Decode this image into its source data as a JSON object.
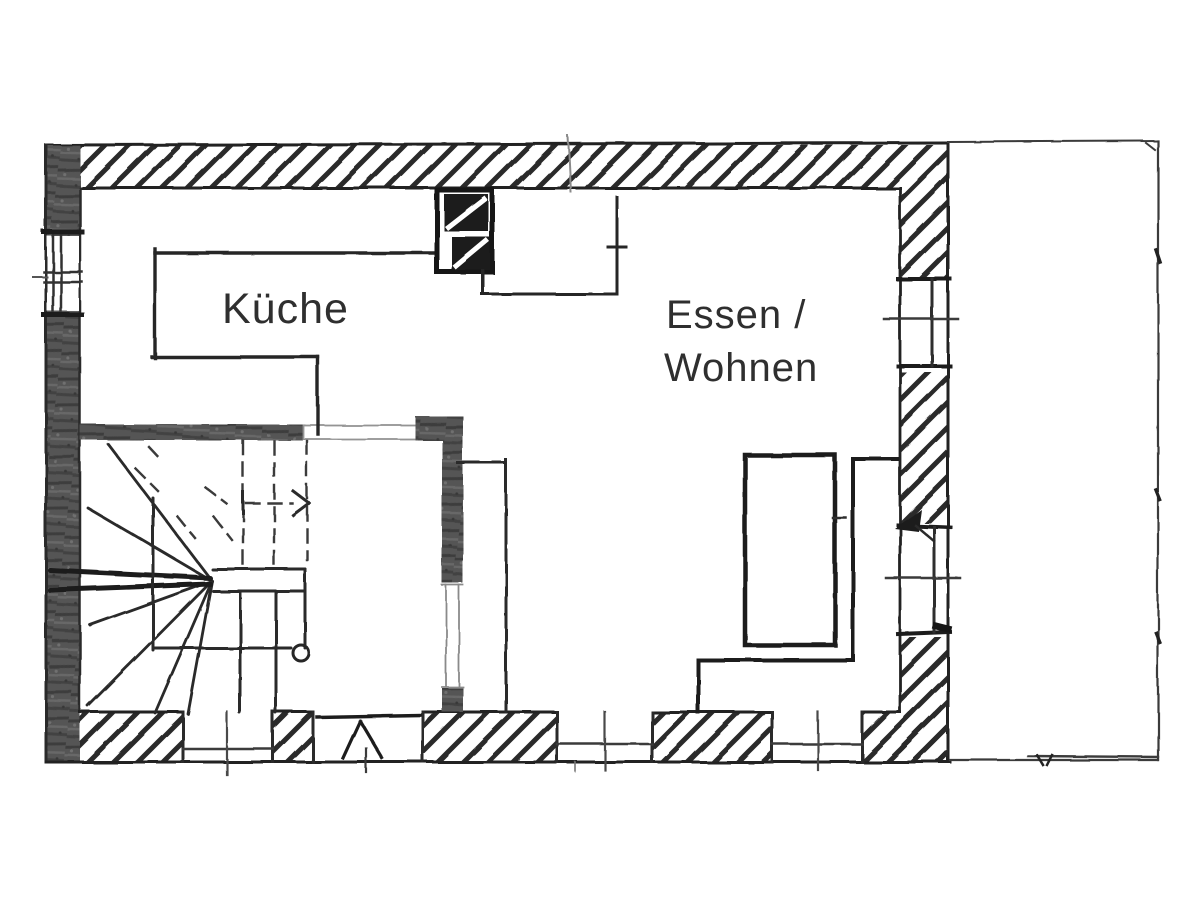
{
  "drawing": {
    "kind": "hand-drawn floor plan sketch",
    "labels": {
      "kitchen": "Küche",
      "dining_living_line1": "Essen /",
      "dining_living_line2": "Wohnen"
    },
    "rooms": [
      {
        "id": "kitchen",
        "label": "Küche"
      },
      {
        "id": "dining-living",
        "label": "Essen / Wohnen"
      }
    ],
    "features": [
      "winder-staircase-with-walking-line-arrow",
      "chimney-flue-block",
      "kitchen-counter",
      "entrance-door-bottom-wall",
      "terrace-outline-right",
      "three-bottom-windows",
      "left-wall-window",
      "right-wall-window",
      "right-wall-terrace-door",
      "column-circle-symbol"
    ],
    "colors": {
      "paper": "#ffffff",
      "ink": "#242424",
      "pencil": "#4a4a4a",
      "wall_graphite": "#555555",
      "hatch": "#2c2c2c",
      "label_text": "#2f2f2f"
    }
  }
}
